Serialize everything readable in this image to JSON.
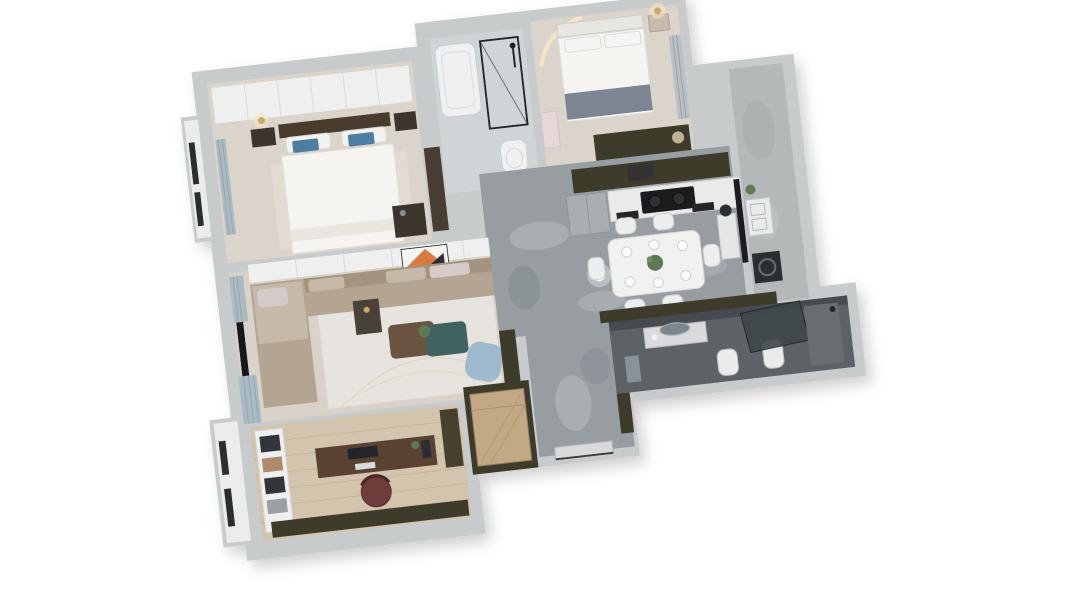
{
  "scene": {
    "title": "3D rendered apartment floor plan (isometric top-down view)",
    "view": "bird's-eye 3D dollhouse render, rotated slightly counter-clockwise",
    "background": "#ffffff"
  },
  "palette": {
    "wallOuter": "#c8cbcc",
    "wallFace": "#eef0f0",
    "ledgeWhite": "#eaeced",
    "windowSlit": "#2b2d2f",
    "floorBedroom": "#dbd4cb",
    "floorLiving": "#d8d2c9",
    "rug": "#e7e3df",
    "marble": "#979da1",
    "marbleVein": "#babfc2",
    "marbleDark": "#7e848a",
    "floorWood": "#d3c4ad",
    "plank": "#c2b296",
    "floorBath1": "#cfd4d6",
    "floorBath2": "#5c6266",
    "bathWallDark": "#454c51",
    "balconyFloor": "#b5b8b9",
    "olive": "#3e3b2b",
    "oliveCabinet": "#46412f",
    "woodWardrobe": "#c2a884",
    "deskWood": "#5a4332",
    "chairMaroon": "#6f3a3b",
    "sofaBase": "#b4a593",
    "sofaBack": "#a2947f",
    "sofaCushion": "#c7b9a8",
    "pillowBlue": "#4e7ea2",
    "pillowPink": "#d6cbc8",
    "headboardDark": "#4a3a2f",
    "darkFurniture": "#3b342d",
    "bedWhite": "#f5f4f1",
    "blanketGrey": "#7b8591",
    "tealTable": "#406260",
    "brownTable": "#6b5340",
    "armchairBlue": "#9fb9cd",
    "curtainBlue": "#a9bac3",
    "tvBlack": "#17191c",
    "cooktopBlack": "#1b1d1f",
    "counterWhite": "#e9eaea",
    "cabinetGrey": "#a9aeb1",
    "applianceDark": "#2b2e31",
    "glassDark": "#40464a",
    "gold": "#c9a869",
    "glowWarm": "#f3e6c2",
    "plantGreen": "#5d7a52",
    "artOrange": "#d97a3f",
    "whitePanel": "#eef0f0",
    "tableWhite": "#f1f1ef",
    "chairWhite": "#edeeee",
    "fixtureWhite": "#eff1f1"
  },
  "rooms": [
    {
      "id": "master-bedroom",
      "name": "Master Bedroom",
      "furniture": [
        "sliding-wardrobe",
        "double-bed",
        "blue-pillows",
        "nightstands",
        "floor-lamp",
        "dresser",
        "window-curtain"
      ]
    },
    {
      "id": "bathroom-1",
      "name": "Bathroom",
      "furniture": [
        "bathtub",
        "glass-shower",
        "toilet"
      ]
    },
    {
      "id": "bedroom-2",
      "name": "Second Bedroom",
      "furniture": [
        "double-bed",
        "grey-throw-blanket",
        "nightstand",
        "table-lamp",
        "arched-light-feature",
        "wardrobe",
        "curtains"
      ]
    },
    {
      "id": "kitchen",
      "name": "Kitchen",
      "furniture": [
        "olive-upper-cabinets",
        "white-counter",
        "gas-cooktop",
        "grey-cabinet-unit",
        "built-in-ovens"
      ]
    },
    {
      "id": "dining-area",
      "name": "Dining Area",
      "furniture": [
        "white-dining-table",
        "six-chairs",
        "plant-centerpiece",
        "pendant-light",
        "shelf-column"
      ]
    },
    {
      "id": "living-room",
      "name": "Living Room",
      "furniture": [
        "l-shaped-sofa",
        "built-in-side-table",
        "coffee-table-duo",
        "blue-armchair",
        "area-rug",
        "tv",
        "curtains",
        "console-band",
        "abstract-artwork"
      ]
    },
    {
      "id": "laundry-balcony",
      "name": "Laundry Balcony",
      "furniture": [
        "laundry-sink",
        "washing-machine",
        "glass-door",
        "plant"
      ]
    },
    {
      "id": "bathroom-2",
      "name": "Master Bathroom",
      "furniture": [
        "vanity",
        "round-mirror",
        "toilet",
        "bidet",
        "glass-shower-screen"
      ]
    },
    {
      "id": "study",
      "name": "Study",
      "furniture": [
        "desk",
        "monitor",
        "maroon-office-chair",
        "bookshelf",
        "olive-low-cabinet",
        "tall-cabinet"
      ]
    },
    {
      "id": "entry",
      "name": "Entry Hall",
      "furniture": [
        "wood-wardrobe",
        "shoe-cabinet",
        "entry-door",
        "marble-floor"
      ]
    }
  ]
}
